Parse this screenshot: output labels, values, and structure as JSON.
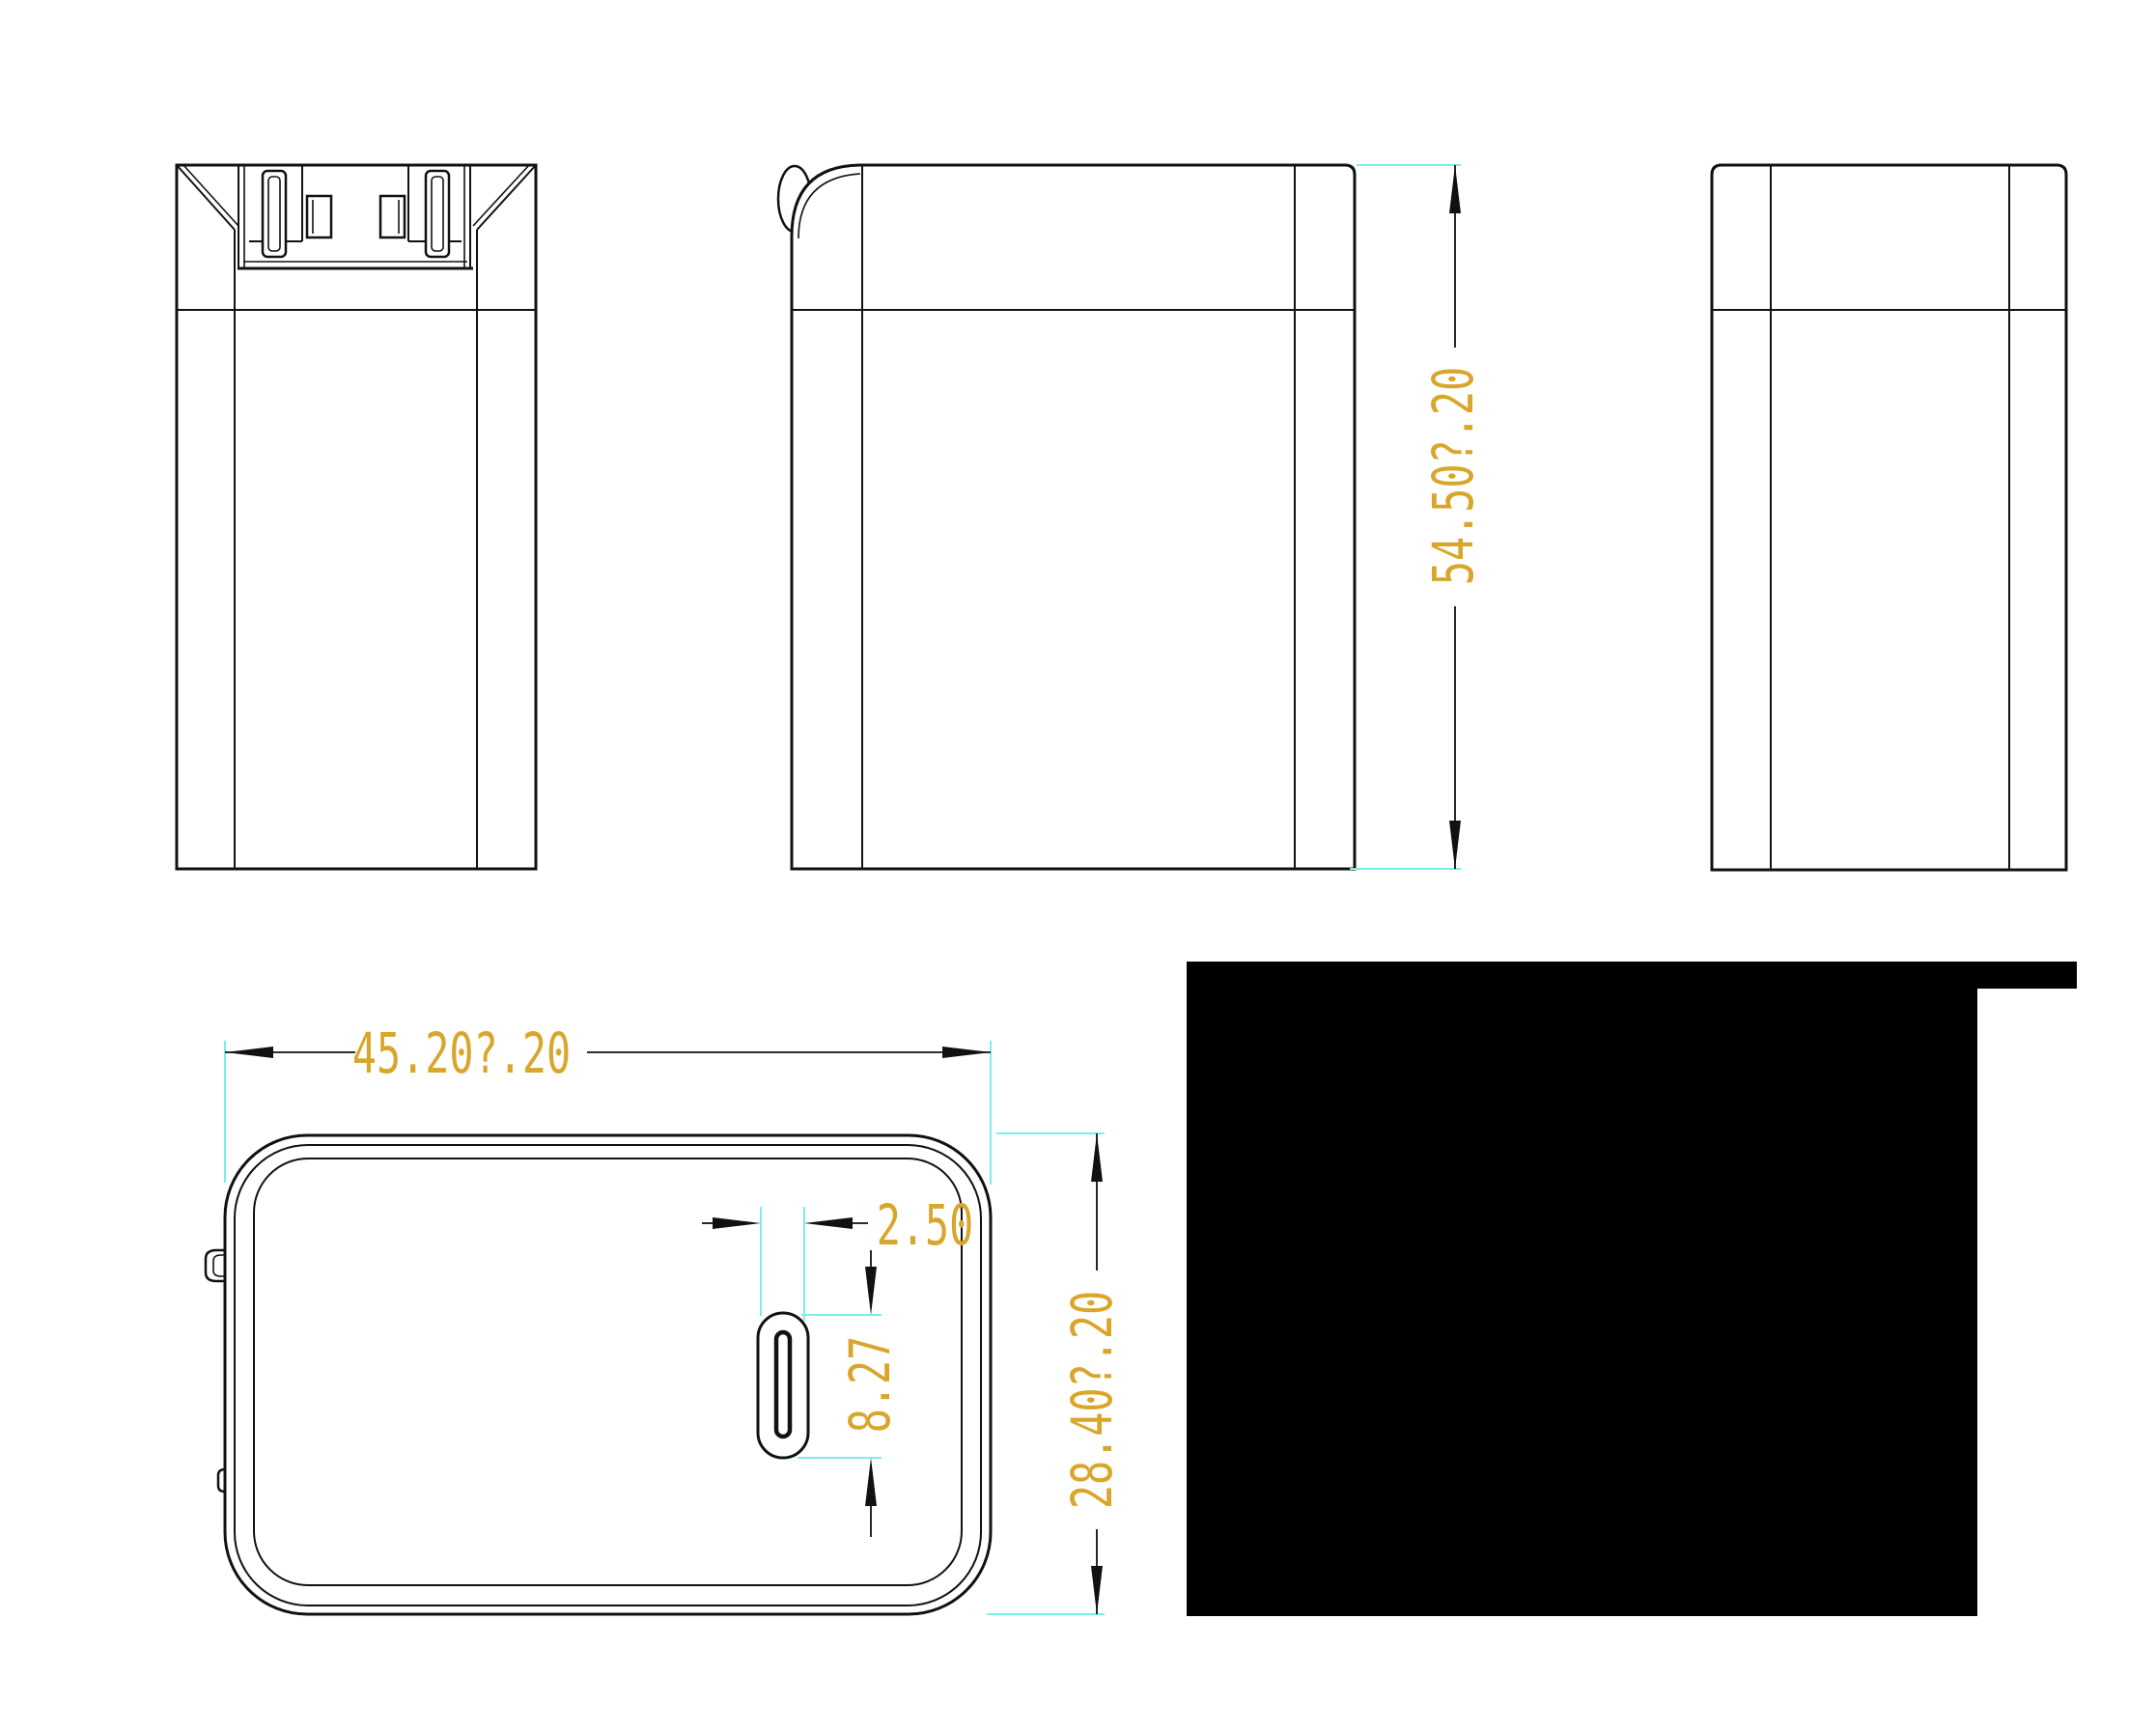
{
  "dimensions": {
    "overall_width": "45.20?.20",
    "overall_height": "54.50?.20",
    "overall_depth": "28.40?.20",
    "port_slot_width": "2.50",
    "port_slot_height": "8.27"
  },
  "colors": {
    "dimension_text": "#D9A62B",
    "extension_line": "#79EFEA",
    "drawing_line": "#111111",
    "redaction_fill": "#000000",
    "background": "#FFFFFF"
  }
}
